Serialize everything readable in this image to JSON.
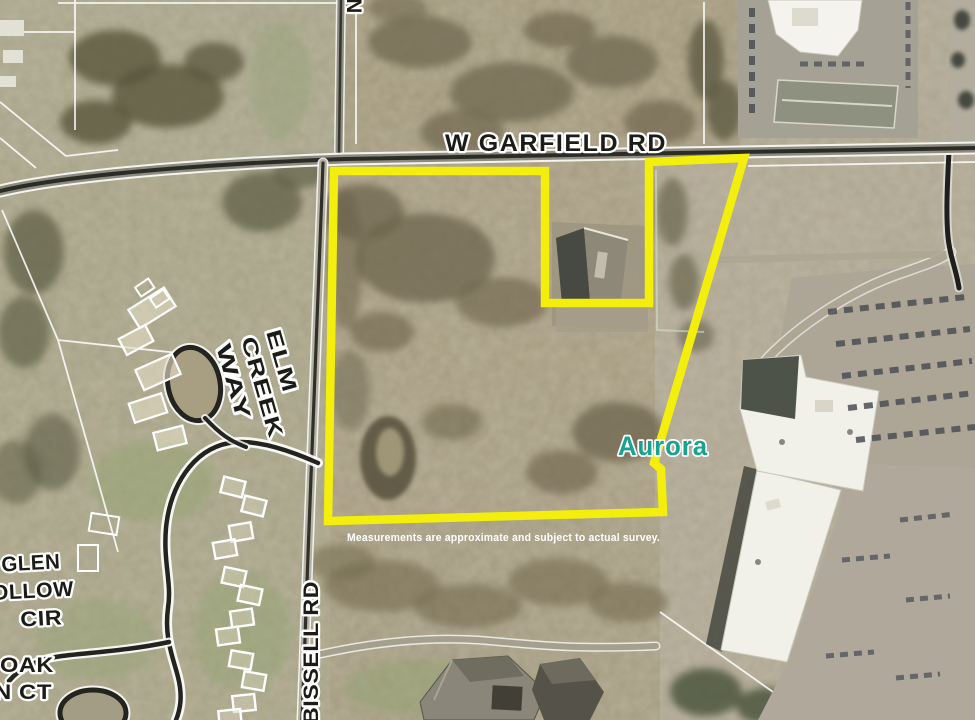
{
  "map": {
    "kind": "aerial parcel map with highlighted property boundary",
    "labels": {
      "garfield": "W GARFIELD RD",
      "bissell": "BISSELL RD",
      "north_partial": "N",
      "elm": [
        "ELM",
        "CREEK",
        "WAY"
      ],
      "glen": [
        "GLEN",
        "HOLLOW",
        "CIR"
      ],
      "oak": [
        "OAK",
        "N CT"
      ],
      "place": "Aurora",
      "disclaimer": "Measurements are approximate and subject to actual survey."
    },
    "colors": {
      "boundary": "#f4ee0c",
      "place": "#18a38f",
      "road_text": "#1b1b18",
      "disclaimer": "#ffffff"
    }
  }
}
